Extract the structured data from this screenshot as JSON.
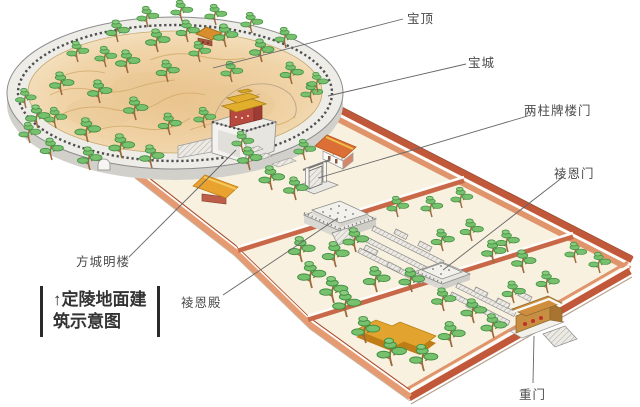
{
  "title": "定陵地面建筑示意图",
  "labels": [
    {
      "id": "baoding",
      "text": "宝顶"
    },
    {
      "id": "baocheng",
      "text": "宝城"
    },
    {
      "id": "liangzhupailoumen",
      "text": "两柱牌楼门"
    },
    {
      "id": "lingenmen",
      "text": "祾恩门"
    },
    {
      "id": "fangchengminglou",
      "text": "方城明楼"
    },
    {
      "id": "lingendian",
      "text": "祾恩殿"
    },
    {
      "id": "chongmen",
      "text": "重门"
    }
  ],
  "caption": {
    "line1": "↑定陵地面建",
    "line2": "筑示意图"
  },
  "colors": {
    "ground": "#f9f1df",
    "wall_red": "#c2583a",
    "wall_salmon": "#e59a72",
    "divider_red": "#c86848",
    "mound_tan": "#ecc18d",
    "ring_wall": "#edece7",
    "tree_green": "#77c06e",
    "tree_dark": "#3e8e3e",
    "roof_gold": "#e2ae2e",
    "roof_red": "#dc6f35",
    "stone": "#e9e8e2",
    "gate_tan": "#c88f42",
    "label_text": "#4b4b4b"
  }
}
